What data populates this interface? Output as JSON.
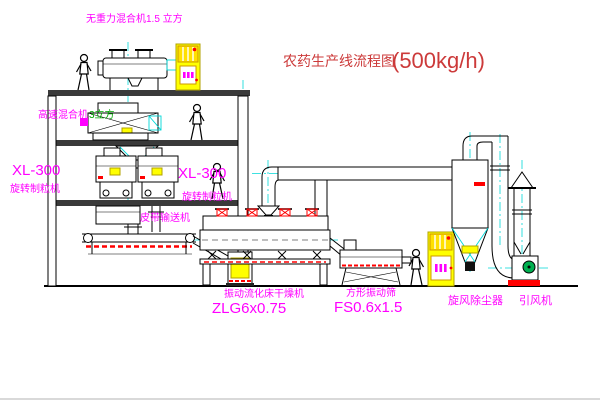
{
  "diagram": {
    "title": "农药生产线流程图",
    "title_capacity": "(500kg/h)"
  },
  "labels": {
    "gravity_mixer": "无重力混合机1.5 立方",
    "high_speed_mixer": "高速混合机",
    "high_speed_mixer_size": "3立方",
    "granulator_left_model": "XL-300",
    "granulator_left_name": "旋转制粒机",
    "granulator_right_model": "XL-300",
    "granulator_right_name": "旋转制粒机",
    "belt_conveyor": "皮带输送机",
    "fluidbed_name": "振动流化床干燥机",
    "fluidbed_model": "ZLG6x0.75",
    "sieve_name": "方形振动筛",
    "sieve_model": "FS0.6x1.5",
    "cyclone_name": "旋风除尘器",
    "fan_name": "引风机"
  },
  "colors": {
    "label_magenta": "#ff00ff",
    "title_red": "#cc3a3a",
    "centerline_cyan": "#00d8d8",
    "cabinet_yellow": "#ffff00",
    "accent_red": "#ff0000",
    "fan_green": "#00b050"
  }
}
